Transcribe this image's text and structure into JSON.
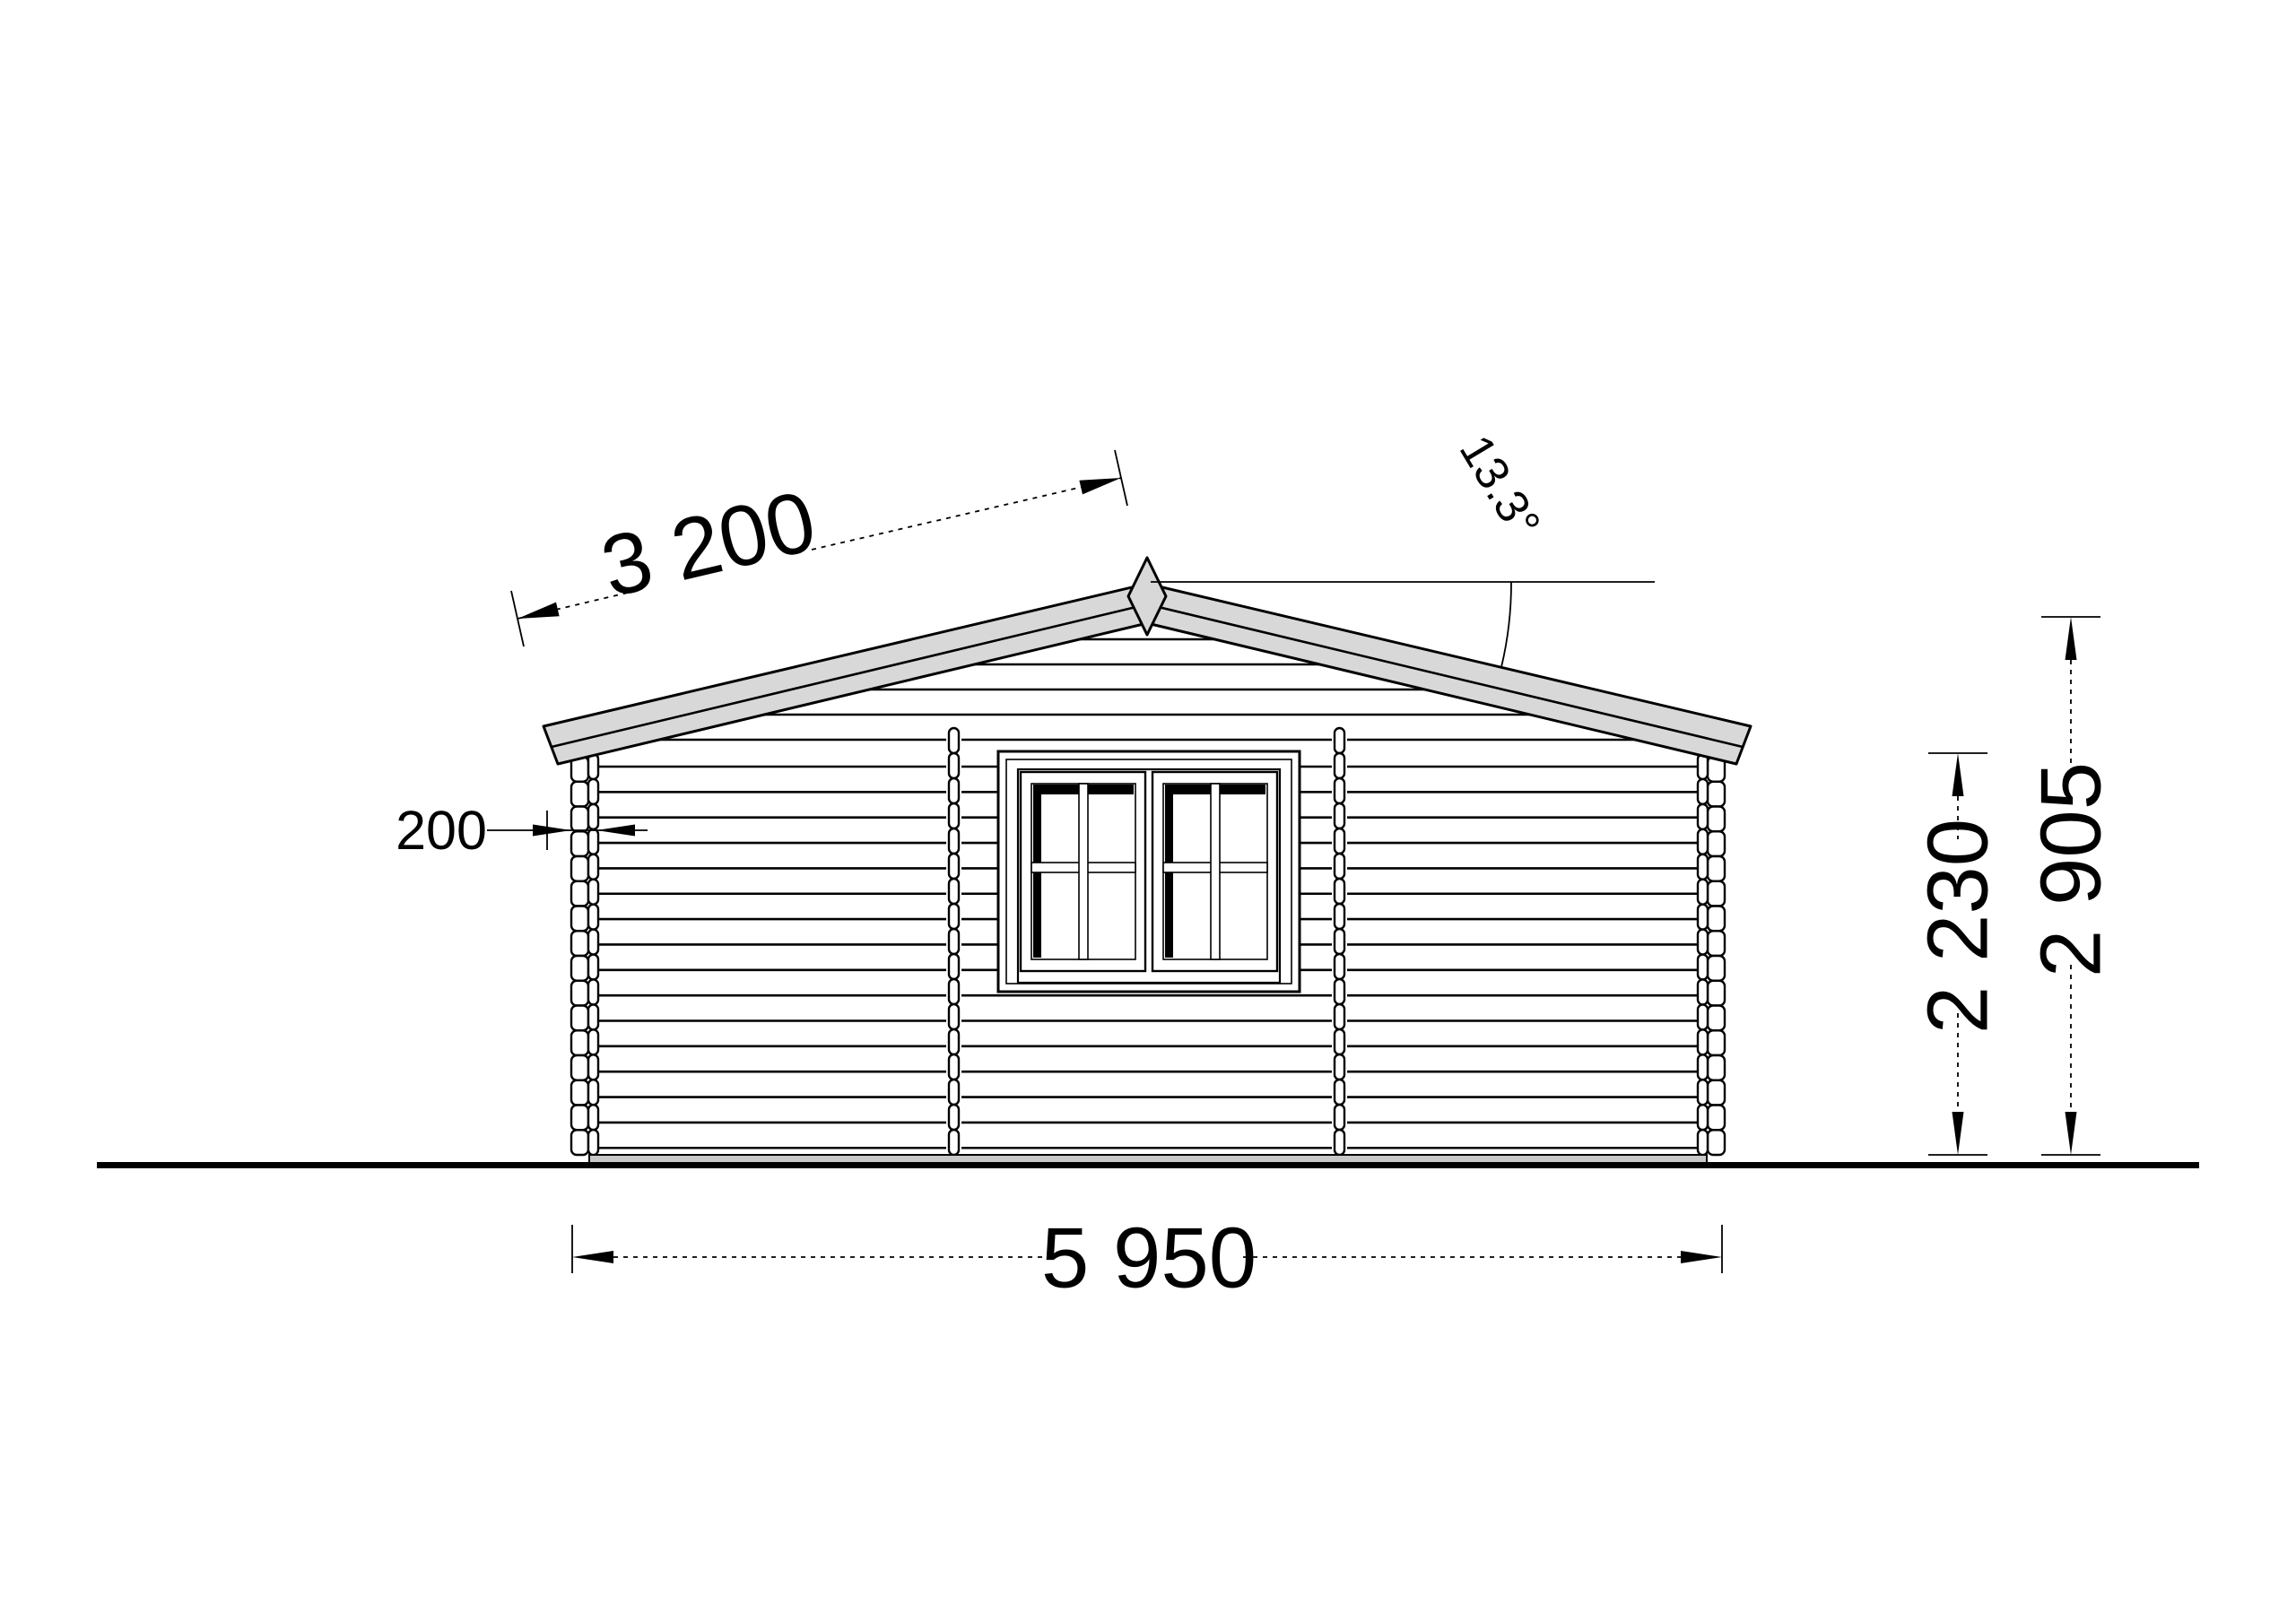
{
  "drawing": {
    "subject": "log-cabin-side-elevation"
  },
  "annotations": {
    "slope_length": {
      "label": "3 200"
    },
    "roof_angle": {
      "label": "13.3°"
    },
    "wall_thickness": {
      "label": "200"
    },
    "wall_height": {
      "label": "2 230"
    },
    "total_height": {
      "label": "2 905"
    },
    "total_width": {
      "label": "5 950"
    }
  },
  "colors": {
    "background": "#ffffff",
    "line": "#000000",
    "roof_fill": "#d8d8d8",
    "base_fill": "#c8c8c8"
  }
}
